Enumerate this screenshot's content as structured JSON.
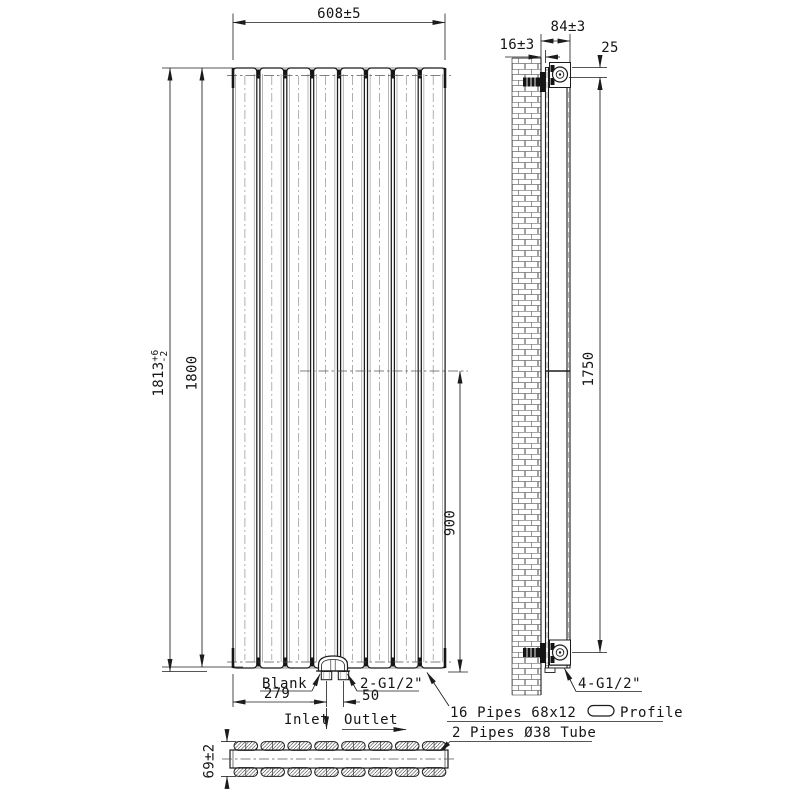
{
  "drawing": {
    "front_view": {
      "dim_width": "608±5",
      "dim_height_overall": {
        "main": "1813",
        "tol_plus": "+6",
        "tol_minus": "-2"
      },
      "dim_height_panel": "1800",
      "dim_center": "900",
      "dim_inlet_offset": "279",
      "dim_io_spacing": "50",
      "label_blank": "Blank",
      "label_connections": "2-G1/2\"",
      "label_inlet": "Inlet",
      "label_outlet": "Outlet",
      "panel_count": 8
    },
    "side_view": {
      "dim_wall_gap": "16±3",
      "dim_depth_from_wall": "84±3",
      "dim_top_offset": "25",
      "dim_bracket_span": "1750",
      "label_connections": "4-G1/2\""
    },
    "section_view": {
      "dim_depth": "69±2",
      "pipes_per_row": 8
    },
    "notes": {
      "note_profile_prefix": "16 Pipes 68x12",
      "note_profile_suffix": "Profile",
      "note_tube": "2 Pipes Ø38 Tube"
    },
    "colors": {
      "line": "#1c1c1c",
      "background": "#ffffff"
    }
  }
}
